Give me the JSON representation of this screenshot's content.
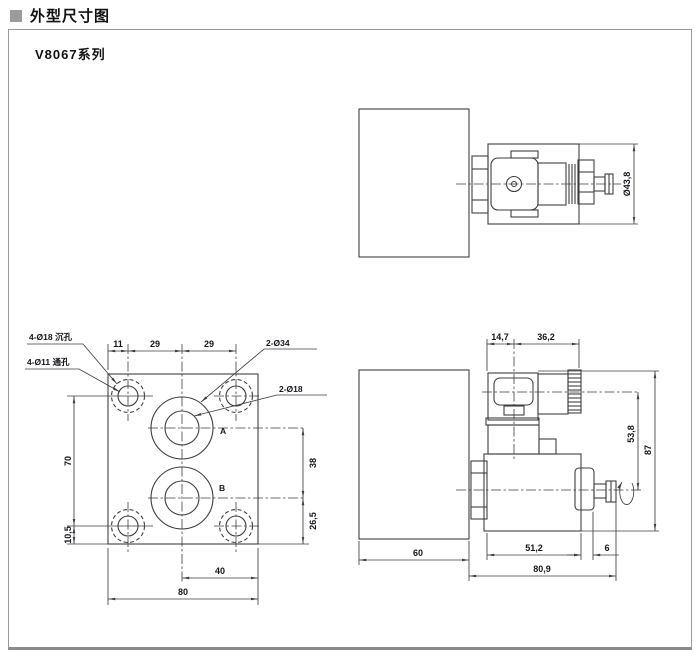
{
  "header": {
    "title": "外型尺寸图"
  },
  "panel": {
    "series": "V8067系列"
  },
  "end_view": {
    "dims": {
      "coil_diameter": "Ø43,8"
    }
  },
  "front_view": {
    "leaders": {
      "counterbore": "4-Ø18 沉孔",
      "through_hole": "4-Ø11 通孔",
      "large_bore": "2-Ø34",
      "small_bore": "2-Ø18"
    },
    "ports": {
      "a": "A",
      "b": "B"
    },
    "dims": {
      "top_left": "11",
      "top_mid": "29",
      "top_right": "29",
      "left_span": "70",
      "left_bottom": "10,5",
      "right_upper": "38",
      "right_lower": "26,5",
      "bottom_inner": "40",
      "bottom_outer": "80"
    }
  },
  "side_view": {
    "dims": {
      "top_left": "14,7",
      "top_right": "36,2",
      "axis_offset": "53,8",
      "total_height": "87",
      "block_width": "60",
      "coil_length": "51,2",
      "override_len": "6",
      "total_length": "80,9"
    }
  },
  "colors": {
    "line": "#3f3f3f",
    "text": "#15151c",
    "border": "#9a9a9a",
    "bullet": "#9c9c9c"
  }
}
